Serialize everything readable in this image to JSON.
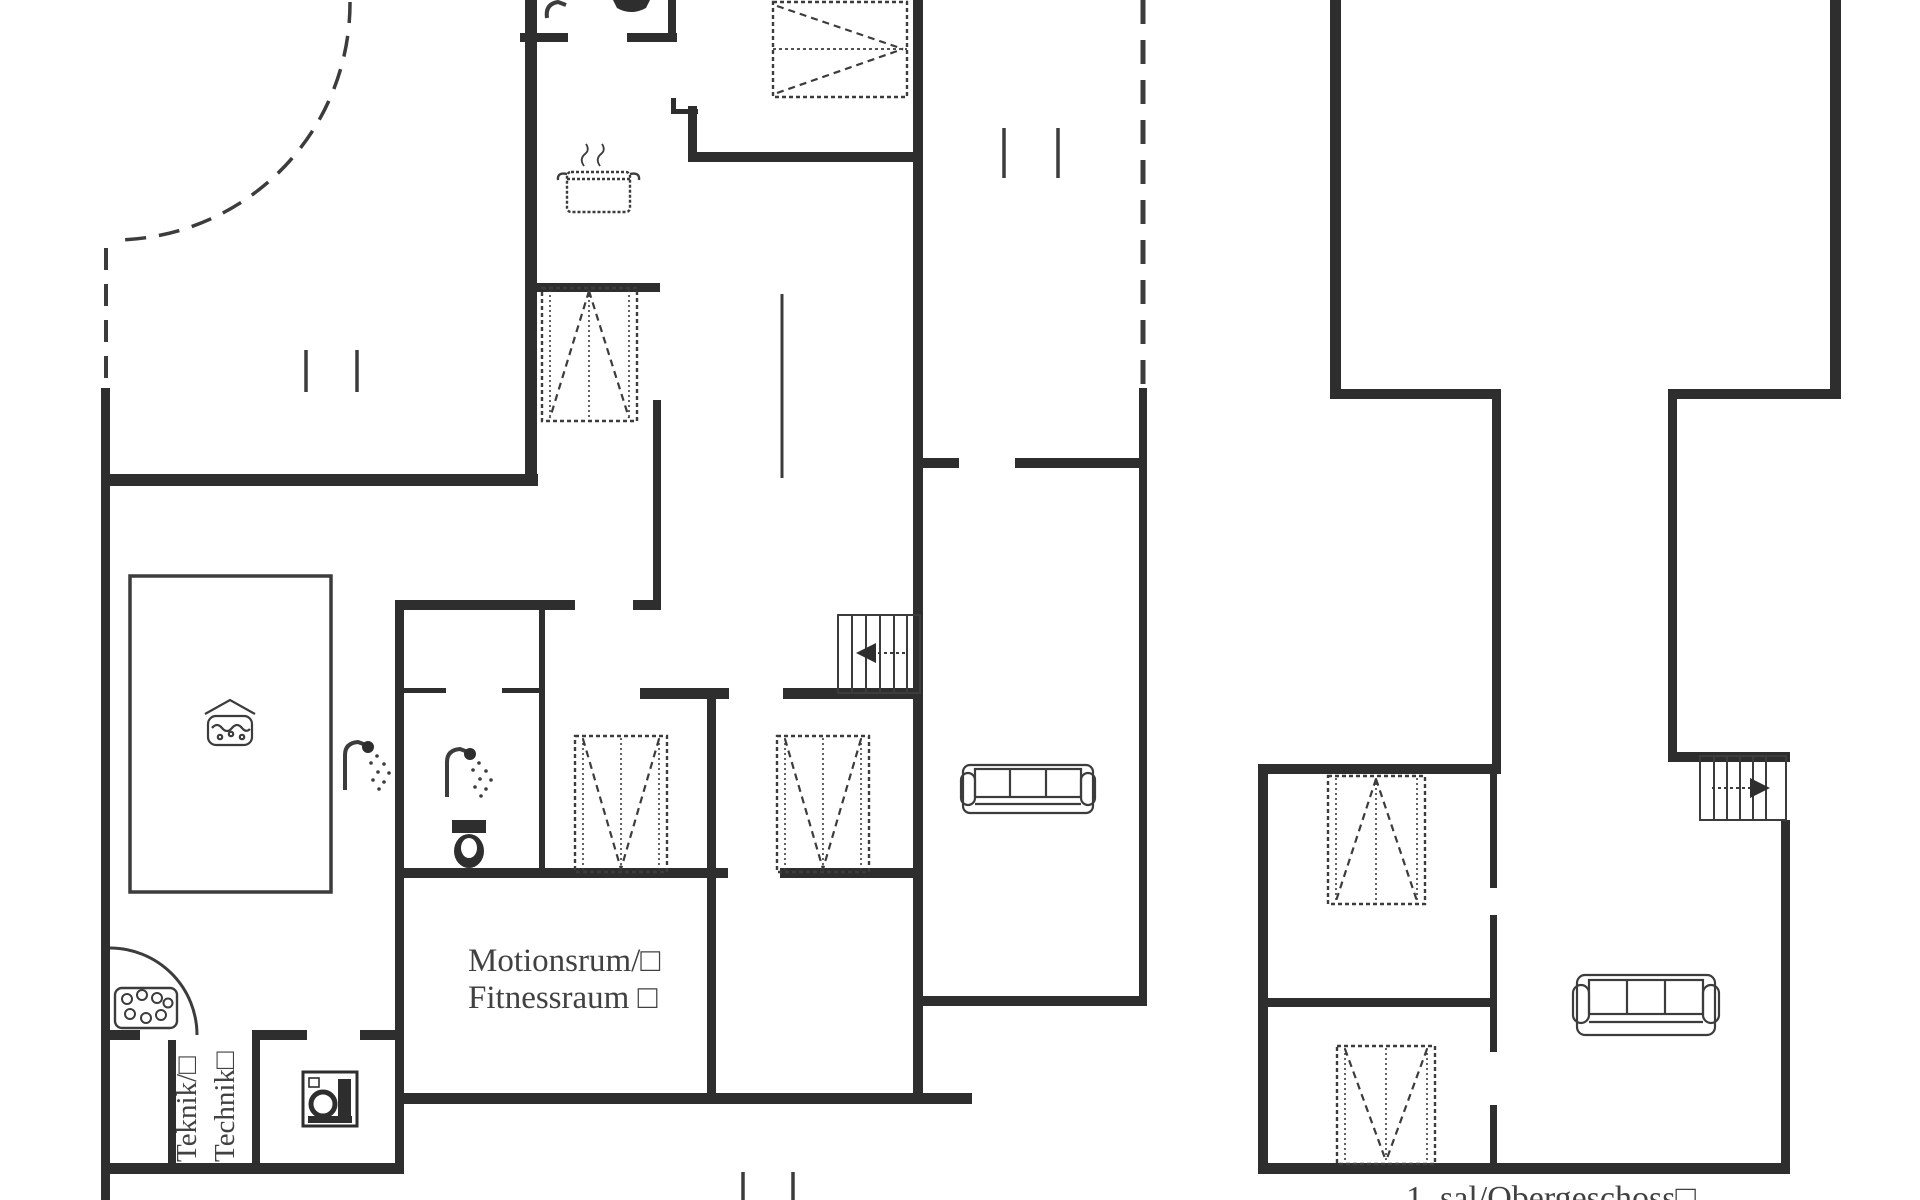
{
  "document": {
    "type": "floor-plan",
    "floor_caption": "1. sal/Obergeschoss□",
    "labels": {
      "fitness_line1": "Motionsrum/□",
      "fitness_line2": "Fitnessraum □",
      "technik_line1": "Teknik/□",
      "technik_line2": "Technik□"
    },
    "colors": {
      "ink": "#2e2e2e",
      "line": "#3c3c3c",
      "text": "#414141",
      "paper": "#ffffff"
    },
    "icons": [
      "cooking-pot-icon",
      "shower-icon",
      "toilet-icon",
      "washing-machine-icon",
      "sauna-stones-icon",
      "whirlpool-icon",
      "wardrobe-icon",
      "double-wardrobe-icon",
      "sofa-icon",
      "stairs-up-arrow-icon",
      "door-swing-arc",
      "terrace-dashed-boundary"
    ]
  }
}
